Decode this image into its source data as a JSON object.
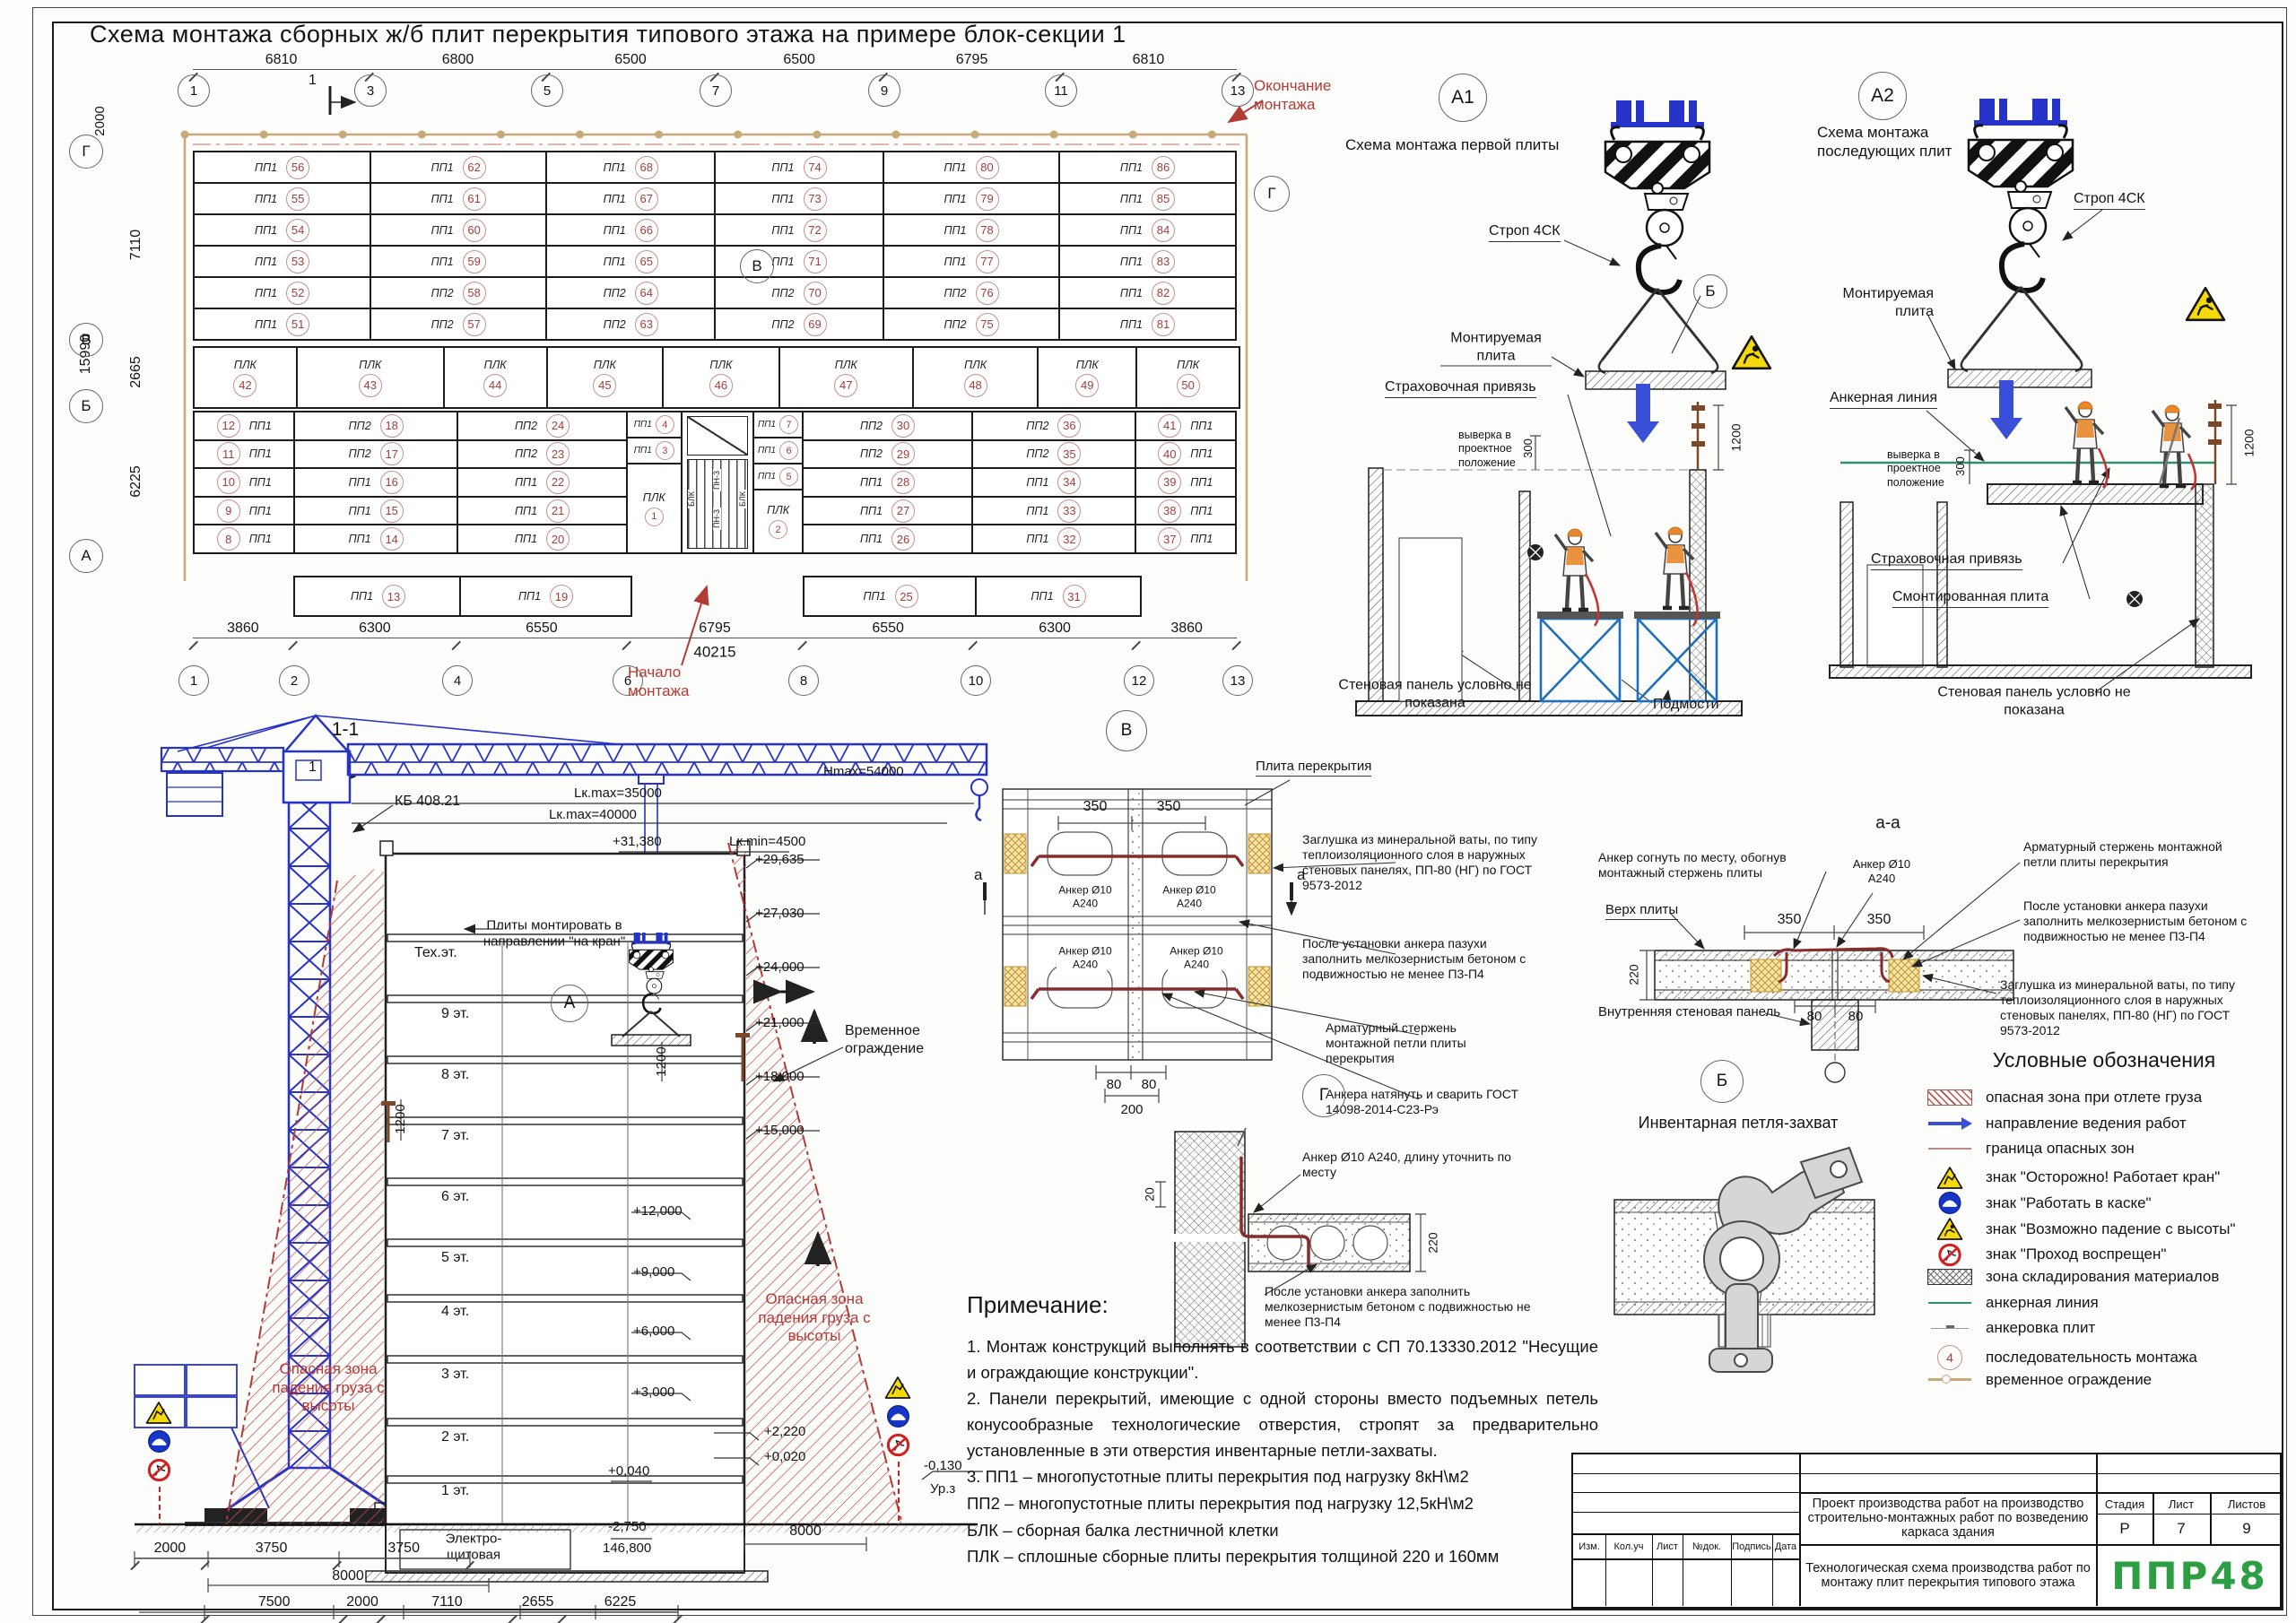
{
  "sheet": {
    "title": "Схема монтажа сборных ж/б плит перекрытия типового этажа на примере блок-секции 1"
  },
  "plan": {
    "grids_top": [
      "1",
      "3",
      "5",
      "7",
      "9",
      "11",
      "13"
    ],
    "dims_top": [
      "6810",
      "6800",
      "6500",
      "6500",
      "6795",
      "6810"
    ],
    "grids_bottom": [
      "1",
      "2",
      "4",
      "6",
      "8",
      "10",
      "12",
      "13"
    ],
    "dims_bottom": [
      "3860",
      "6300",
      "6550",
      "6795",
      "6550",
      "6300",
      "3860"
    ],
    "dim_bottom_total": "40215",
    "rows_left": [
      "Г",
      "В",
      "Б",
      "А"
    ],
    "dims_left": [
      "2000",
      "7110",
      "2665",
      "6225"
    ],
    "dim_left_total": "15990",
    "finish_label": "Окончание монтажа",
    "start_label": "Начало монтажа",
    "ref_v": "В",
    "ref_g": "Г",
    "cut_mark": "1",
    "plk_mark": "ПЛК",
    "top_band": [
      [
        {
          "m": "ПП1",
          "n": "56"
        },
        {
          "m": "ПП1",
          "n": "55"
        },
        {
          "m": "ПП1",
          "n": "54"
        },
        {
          "m": "ПП1",
          "n": "53"
        },
        {
          "m": "ПП1",
          "n": "52"
        },
        {
          "m": "ПП1",
          "n": "51"
        }
      ],
      [
        {
          "m": "ПП1",
          "n": "62"
        },
        {
          "m": "ПП1",
          "n": "61"
        },
        {
          "m": "ПП1",
          "n": "60"
        },
        {
          "m": "ПП1",
          "n": "59"
        },
        {
          "m": "ПП2",
          "n": "58"
        },
        {
          "m": "ПП2",
          "n": "57"
        }
      ],
      [
        {
          "m": "ПП1",
          "n": "68"
        },
        {
          "m": "ПП1",
          "n": "67"
        },
        {
          "m": "ПП1",
          "n": "66"
        },
        {
          "m": "ПП1",
          "n": "65"
        },
        {
          "m": "ПП2",
          "n": "64"
        },
        {
          "m": "ПП2",
          "n": "63"
        }
      ],
      [
        {
          "m": "ПП1",
          "n": "74"
        },
        {
          "m": "ПП1",
          "n": "73"
        },
        {
          "m": "ПП1",
          "n": "72"
        },
        {
          "m": "ПП1",
          "n": "71"
        },
        {
          "m": "ПП2",
          "n": "70"
        },
        {
          "m": "ПП2",
          "n": "69"
        }
      ],
      [
        {
          "m": "ПП1",
          "n": "80"
        },
        {
          "m": "ПП1",
          "n": "79"
        },
        {
          "m": "ПП1",
          "n": "78"
        },
        {
          "m": "ПП1",
          "n": "77"
        },
        {
          "m": "ПП2",
          "n": "76"
        },
        {
          "m": "ПП2",
          "n": "75"
        }
      ],
      [
        {
          "m": "ПП1",
          "n": "86"
        },
        {
          "m": "ПП1",
          "n": "85"
        },
        {
          "m": "ПП1",
          "n": "84"
        },
        {
          "m": "ПП1",
          "n": "83"
        },
        {
          "m": "ПП1",
          "n": "82"
        },
        {
          "m": "ПП1",
          "n": "81"
        }
      ]
    ],
    "plk_band": [
      "42",
      "43",
      "44",
      "45",
      "46",
      "47",
      "48",
      "49",
      "50"
    ],
    "bottom_band": [
      [
        {
          "m": "ПП1",
          "n": "12"
        },
        {
          "m": "ПП1",
          "n": "11"
        },
        {
          "m": "ПП1",
          "n": "10"
        },
        {
          "m": "ПП1",
          "n": "9"
        },
        {
          "m": "ПП1",
          "n": "8"
        }
      ],
      [
        {
          "m": "ПП2",
          "n": "18"
        },
        {
          "m": "ПП2",
          "n": "17"
        },
        {
          "m": "ПП1",
          "n": "16"
        },
        {
          "m": "ПП1",
          "n": "15"
        },
        {
          "m": "ПП1",
          "n": "14"
        }
      ],
      [
        {
          "m": "ПП2",
          "n": "24"
        },
        {
          "m": "ПП2",
          "n": "23"
        },
        {
          "m": "ПП1",
          "n": "22"
        },
        {
          "m": "ПП1",
          "n": "21"
        },
        {
          "m": "ПП1",
          "n": "20"
        }
      ],
      [
        {
          "m": "ПП2",
          "n": "30"
        },
        {
          "m": "ПП2",
          "n": "29"
        },
        {
          "m": "ПП1",
          "n": "28"
        },
        {
          "m": "ПП1",
          "n": "27"
        },
        {
          "m": "ПП1",
          "n": "26"
        }
      ],
      [
        {
          "m": "ПП2",
          "n": "36"
        },
        {
          "m": "ПП2",
          "n": "35"
        },
        {
          "m": "ПП1",
          "n": "34"
        },
        {
          "m": "ПП1",
          "n": "33"
        },
        {
          "m": "ПП1",
          "n": "32"
        }
      ],
      [
        {
          "m": "ПП1",
          "n": "41"
        },
        {
          "m": "ПП1",
          "n": "40"
        },
        {
          "m": "ПП1",
          "n": "39"
        },
        {
          "m": "ПП1",
          "n": "38"
        },
        {
          "m": "ПП1",
          "n": "37"
        }
      ]
    ],
    "below_band": [
      {
        "m": "ПП1",
        "n": "13"
      },
      {
        "m": "ПП1",
        "n": "19"
      },
      {
        "m": "ПП1",
        "n": "25"
      },
      {
        "m": "ПП1",
        "n": "31"
      }
    ],
    "stair": {
      "left": [
        {
          "m": "ПП1",
          "n": "4"
        },
        {
          "m": "ПП1",
          "n": "3"
        }
      ],
      "plk1_n": "1",
      "right": [
        {
          "m": "ПП1",
          "n": "7"
        },
        {
          "m": "ПП1",
          "n": "6"
        },
        {
          "m": "ПП1",
          "n": "5"
        }
      ],
      "plk2_n": "2",
      "blk": "БЛК",
      "pn": "ПН-3"
    }
  },
  "section": {
    "title": "1-1",
    "crane": "КБ 408.21",
    "lk1": "Lк.max=35000",
    "lk2": "Lк.max=40000",
    "lk3": "Lк.min=4500",
    "hmax": "Hmax=54000",
    "elev_jib": "+31,380",
    "mount": "Плиты монтировать в направлении \"на кран\"",
    "floors": [
      "Тех.эт.",
      "9 эт.",
      "8 эт.",
      "7 эт.",
      "6 эт.",
      "5 эт.",
      "4 эт.",
      "3 эт.",
      "2 эт.",
      "1 эт."
    ],
    "elev_right": [
      "+29,635",
      "+27,030",
      "+24,000",
      "+21,000",
      "+18,000",
      "+15,000"
    ],
    "elev_inner": [
      "+12,000",
      "+9,000",
      "+6,000",
      "+3,000"
    ],
    "elev_fence": [
      "+2,220",
      "+0,020"
    ],
    "elev_floor": "+0,040",
    "elev_bsm": "-2,750",
    "area": "146,800",
    "elev_gr": "-0,130",
    "gr": "Ур.з",
    "fence": "Временное ограждение",
    "danger": "Опасная зона падения груза с высоты",
    "room": "Электро-щитовая",
    "d1200": "1200",
    "node_a": "А",
    "dims_b1": [
      "2000",
      "3750",
      "3750"
    ],
    "d8000": "8000",
    "dims_b2": [
      "7500",
      "2000",
      "7110",
      "2655",
      "6225"
    ],
    "d8000r": "8000"
  },
  "node_v": {
    "ref": "В",
    "slab": "Плита перекрытия",
    "d350": [
      "350",
      "350"
    ],
    "anchor": "Анкер Ø10 А240",
    "d80": [
      "80",
      "80"
    ],
    "d200": "200",
    "cut": "а",
    "note_plug": "Заглушка из минеральной ваты, по типу теплоизоляционного слоя в наружных стеновых панелях, ПП-80 (НГ) по ГОСТ 9573-2012",
    "note_fill": "После установки анкера пазухи заполнить мелкозернистым бетоном с подвижностью не менее П3-П4",
    "note_rod": "Арматурный стержень монтажной петли плиты перекрытия",
    "note_weld": "Анкера натянуть и сварить ГОСТ 14098-2014-С23-Рэ"
  },
  "node_aa": {
    "title": "а-а",
    "bend": "Анкер согнуть по месту, обогнув монтажный стержень плиты",
    "top": "Верх плиты",
    "anchor": "Анкер Ø10 А240",
    "d350": [
      "350",
      "350"
    ],
    "d220": "220",
    "d80": [
      "80",
      "80"
    ],
    "rod": "Арматурный стержень монтажной петли плиты перекрытия",
    "fill": "После установки анкера пазухи заполнить мелкозернистым бетоном с подвижностью не менее П3-П4",
    "plug": "Заглушка из минеральной ваты, по типу теплоизоляционного слоя в наружных стеновых панелях, ПП-80 (НГ) по ГОСТ 9573-2012",
    "wall": "Внутренняя стеновая панель"
  },
  "node_g": {
    "ref": "Г",
    "d20": "20",
    "d220": "220",
    "anchor": "Анкер Ø10 А240, длину уточнить по месту",
    "fill": "После установки анкера заполнить мелкозернистым бетоном с подвижностью не менее П3-П4"
  },
  "node_b": {
    "ref": "Б",
    "label": "Инвентарная петля-захват"
  },
  "a1": {
    "ref": "А1",
    "title": "Схема монтажа первой плиты",
    "sling": "Строп 4СК",
    "plate": "Монтируемая плита",
    "ref_b": "Б",
    "harness": "Страховочная привязь",
    "align": "выверка в проектное положение",
    "d300": "300",
    "d1200": "1200",
    "wall": "Стеновая панель условно не показана",
    "scaffold": "Подмости"
  },
  "a2": {
    "ref": "А2",
    "title": "Схема монтажа последующих плит",
    "sling": "Строп 4СК",
    "plate": "Монтируемая плита",
    "aline": "Анкерная линия",
    "align": "выверка в проектное положение",
    "d300": "300",
    "d1200": "1200",
    "harness": "Страховочная привязь",
    "mounted": "Смонтированная плита",
    "wall": "Стеновая панель условно не показана"
  },
  "legend": {
    "title": "Условные обозначения",
    "items": [
      {
        "icon": "hatch-red",
        "label": "опасная зона при отлете груза"
      },
      {
        "icon": "arrow-blue",
        "label": "направление ведения работ"
      },
      {
        "icon": "line-red",
        "label": "граница опасных зон"
      },
      {
        "icon": "sign-crane",
        "label": "знак \"Осторожно! Работает кран\""
      },
      {
        "icon": "sign-helmet",
        "label": "знак \"Работать в каске\""
      },
      {
        "icon": "sign-fall",
        "label": "знак \"Возможно падение с высоты\""
      },
      {
        "icon": "sign-noentry",
        "label": "знак \"Проход воспрещен\""
      },
      {
        "icon": "zone-storage",
        "label": "зона складирования материалов"
      },
      {
        "icon": "line-green",
        "label": "анкерная линия"
      },
      {
        "icon": "line-gray",
        "label": "анкеровка плит"
      },
      {
        "icon": "seq-num",
        "label": "последовательность монтажа",
        "num": "4"
      },
      {
        "icon": "fence-line",
        "label": "временное ограждение"
      }
    ]
  },
  "notes": {
    "title": "Примечание:",
    "lines": [
      "1.  Монтаж  конструкций  выполнять  в  соответствии  с  СП 70.13330.2012 \"Несущие и ограждающие конструкции\".",
      "2.  Панели  перекрытий,  имеющие  с  одной  стороны  вместо подъемных петель конусообразные технологические отверстия, стропят  за  предварительно  установленные  в  эти  отверстия инвентарные петли-захваты.",
      "3.  ПП1 – многопустотные плиты перекрытия под нагрузку 8кН\\м2",
      "ПП2 – многопустотные плиты перекрытия под нагрузку 12,5кН\\м2",
      "БЛК – сборная балка лестничной клетки",
      "ПЛК – сплошные сборные плиты перекрытия толщиной 220 и 160мм"
    ]
  },
  "tb": {
    "project": "Проект производства работ на производство строительно-монтажных работ по возведению каркаса здания",
    "doc": "Технологическая схема производства работ по монтажу плит перекрытия типового этажа",
    "h_stage": "Стадия",
    "h_sheet": "Лист",
    "h_sheets": "Листов",
    "stage": "Р",
    "sheet": "7",
    "sheets": "9",
    "logo": "ППР48",
    "rev": [
      "Изм.",
      "Кол.уч",
      "Лист",
      "№док.",
      "Подпись",
      "Дата"
    ]
  }
}
